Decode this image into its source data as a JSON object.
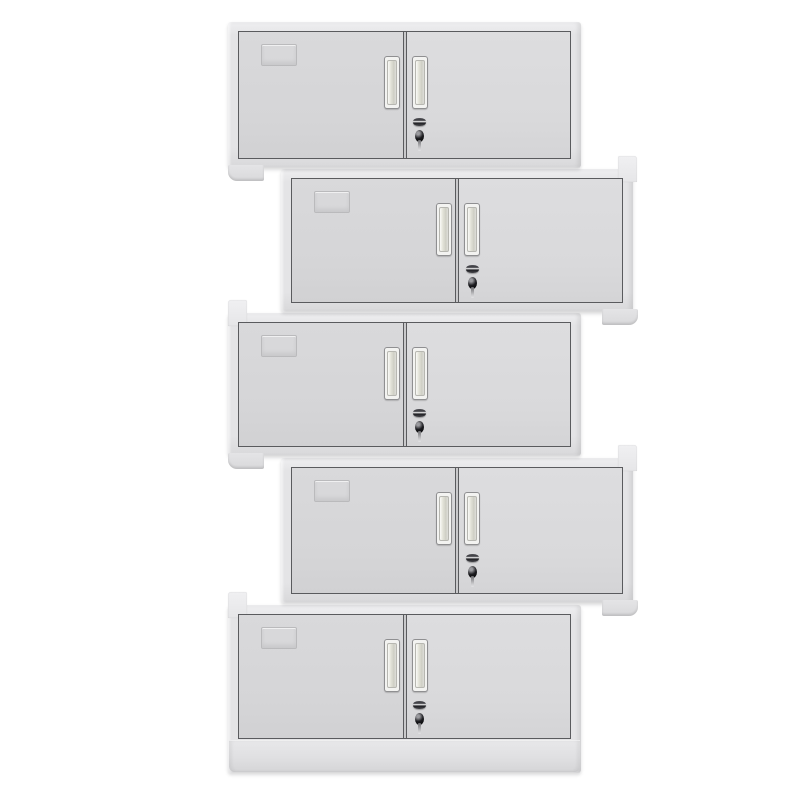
{
  "image": {
    "kind": "product-photo",
    "alt": "Five identical light-gray two-door steel storage cabinets stacked vertically in an alternating left-right staggered arrangement on a white background",
    "unit_count": 5,
    "visible_text": ""
  },
  "colors": {
    "bg": "#ffffff",
    "body": "#e4e4e6",
    "body_light": "#efeff1",
    "body_dark": "#d8d8da",
    "door_face": "#d7d7d9",
    "line": "#5a5b5e",
    "seam_light": "#c9c9cb",
    "handle_frame": "#f3f3f1",
    "handle_border": "#8f8f91",
    "slot_a": "#e3e3d9",
    "slot_b": "#cfcfc5",
    "lock": "#1c1c20",
    "label_line": "#b5b5b7"
  },
  "features": {
    "doors_per_cabinet": 2,
    "handle_style": "recessed vertical pull, one per door, flanking center seam",
    "lock_position": "right door, below handle, key inserted",
    "label_holder_position": "left door, upper left, embossed frame",
    "bottom_unit_has_plinth": true
  },
  "cabinets": [
    {
      "id": 1,
      "offset": "left",
      "x": 228,
      "y": 22,
      "w": 353,
      "h": 146,
      "door_bottom": 9,
      "post": null,
      "foot": "left",
      "plinth": false,
      "z": 50
    },
    {
      "id": 2,
      "offset": "right",
      "x": 281,
      "y": 169,
      "w": 352,
      "h": 143,
      "door_bottom": 9,
      "post": "right",
      "foot": "right",
      "plinth": false,
      "z": 40
    },
    {
      "id": 3,
      "offset": "left",
      "x": 228,
      "y": 313,
      "w": 353,
      "h": 143,
      "door_bottom": 9,
      "post": "left",
      "foot": "left",
      "plinth": false,
      "z": 30
    },
    {
      "id": 4,
      "offset": "right",
      "x": 281,
      "y": 458,
      "w": 352,
      "h": 145,
      "door_bottom": 9,
      "post": "right",
      "foot": "right",
      "plinth": false,
      "z": 20
    },
    {
      "id": 5,
      "offset": "left",
      "x": 228,
      "y": 605,
      "w": 353,
      "h": 168,
      "door_bottom": 34,
      "post": "left",
      "foot": null,
      "plinth": true,
      "z": 10
    }
  ]
}
